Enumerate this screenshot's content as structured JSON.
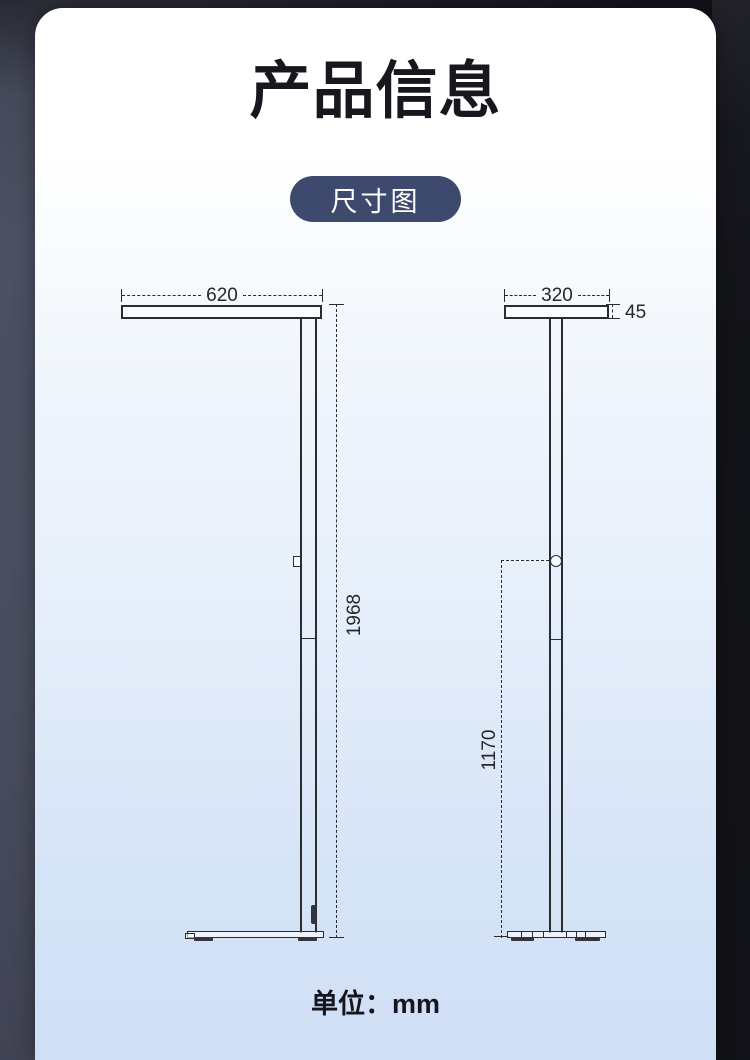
{
  "header": {
    "title": "产品信息",
    "badge_label": "尺寸图"
  },
  "diagram": {
    "title": "尺寸图",
    "unit": "mm",
    "front_view": {
      "name": "落地灯正视图",
      "width": "620",
      "height": "1968"
    },
    "side_view": {
      "name": "落地灯侧视图",
      "depth": "320",
      "head_thickness": "45",
      "switch_height": "1170"
    }
  },
  "footer": {
    "unit_label": "单位：mm"
  },
  "colors": {
    "badge_bg": "#3d4a6d",
    "badge_text": "#ffffff",
    "title_text": "#17181d",
    "drawing_line": "#2b2c31",
    "card_top": "#ffffff",
    "card_bottom": "#cfdff5",
    "side_strip_left": "#494d5e",
    "side_strip_right": "#131419"
  }
}
